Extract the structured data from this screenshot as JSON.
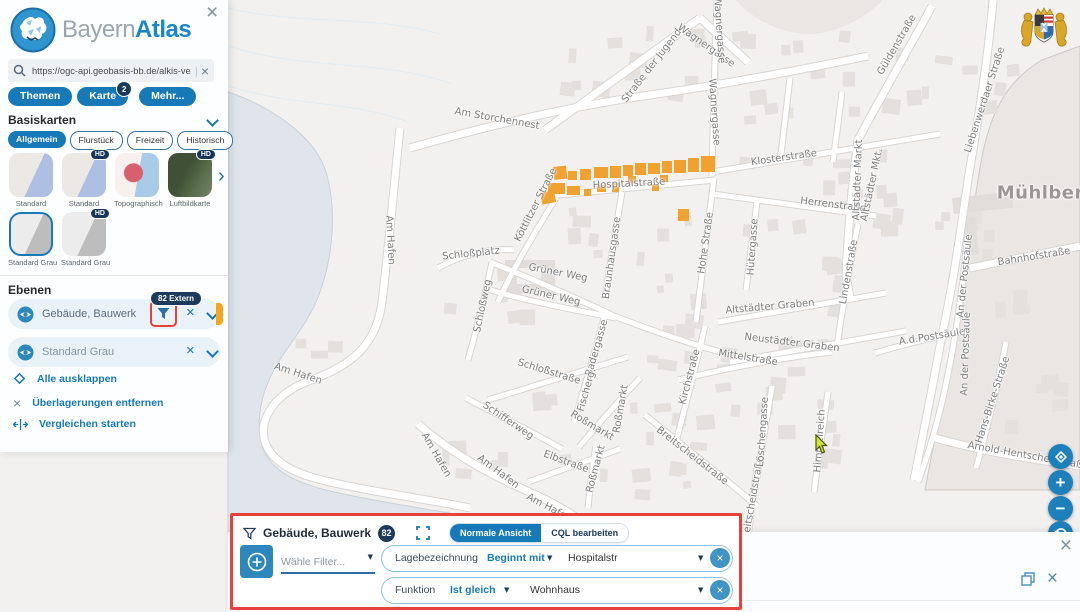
{
  "icons": {
    "close": "×",
    "caret": "▼",
    "arrow_right": "›",
    "plus": "+",
    "minus": "−"
  },
  "sidebar": {
    "logo": {
      "part1": "Bayern",
      "part2": "Atlas"
    },
    "search": {
      "value": "https://ogc-api.geobasis-bb.de/alkis-verein"
    },
    "tabs": [
      {
        "label": "Themen"
      },
      {
        "label": "Karte",
        "badge": "2"
      },
      {
        "label": "Mehr..."
      }
    ],
    "basemaps": {
      "header": "Basiskarten",
      "hd_label": "HD",
      "chips": [
        {
          "label": "Allgemein"
        },
        {
          "label": "Flurstück"
        },
        {
          "label": "Freizeit"
        },
        {
          "label": "Historisch"
        }
      ],
      "thumbs_row1": [
        {
          "label": "Standard"
        },
        {
          "label": "Standard"
        },
        {
          "label": "Topographisch"
        },
        {
          "label": "Luftbildkarte"
        }
      ],
      "thumbs_row2": [
        {
          "label": "Standard Grau"
        },
        {
          "label": "Standard Grau"
        }
      ]
    },
    "layers": {
      "header": "Ebenen",
      "items": [
        {
          "label": "Gebäude, Bauwerk",
          "badge": "82 Extern"
        },
        {
          "label": "Standard Grau"
        }
      ]
    },
    "actions": [
      {
        "label": "Alle ausklappen"
      },
      {
        "label": "Überlagerungen entfernen"
      },
      {
        "label": "Vergleichen starten"
      }
    ]
  },
  "filter_panel": {
    "title": "Gebäude, Bauwerk",
    "count": "82",
    "views": [
      {
        "label": "Normale Ansicht"
      },
      {
        "label": "CQL bearbeiten"
      }
    ],
    "add_placeholder": "Wähle Filter...",
    "rows": [
      {
        "field": "Lagebezeichnung",
        "operator": "Beginnt mit",
        "value": "Hospitalstr"
      },
      {
        "field": "Funktion",
        "operator": "Ist gleich",
        "value": "Wohnhaus"
      }
    ]
  },
  "map": {
    "colors": {
      "accent_blue": "#1779b8",
      "highlight_orange": "#f0a12f",
      "badge_navy": "#1b3a5c",
      "alert_red": "#e8403a"
    },
    "town_label": "Mühlberg",
    "street_labels": [
      {
        "t": "Straße der Jugend",
        "x": 652,
        "y": 66,
        "r": -52
      },
      {
        "t": "Wagnergasse",
        "x": 706,
        "y": 46,
        "r": 35
      },
      {
        "t": "Wagnergasse",
        "x": 719,
        "y": 30,
        "r": 86
      },
      {
        "t": "Wagnergasse",
        "x": 714,
        "y": 112,
        "r": 86
      },
      {
        "t": "Am Storchennest",
        "x": 497,
        "y": 119,
        "r": 10
      },
      {
        "t": "Klosterstraße",
        "x": 784,
        "y": 158,
        "r": -8
      },
      {
        "t": "Hospitalstraße",
        "x": 629,
        "y": 184,
        "r": -3
      },
      {
        "t": "Herrenstraße",
        "x": 833,
        "y": 205,
        "r": 7
      },
      {
        "t": "Güldenstraße",
        "x": 897,
        "y": 45,
        "r": -60
      },
      {
        "t": "Liebenwerdaer Straße",
        "x": 985,
        "y": 100,
        "r": -72
      },
      {
        "t": "Altstädter Markt",
        "x": 858,
        "y": 180,
        "r": -88
      },
      {
        "t": "Altstädter Mkt.",
        "x": 872,
        "y": 185,
        "r": -78
      },
      {
        "t": "Mühlberg",
        "x": 1047,
        "y": 193,
        "r": 0,
        "big": true
      },
      {
        "t": "Schloßplatz",
        "x": 471,
        "y": 254,
        "r": -6
      },
      {
        "t": "Schloßweg",
        "x": 483,
        "y": 306,
        "r": -78
      },
      {
        "t": "Am Hafen",
        "x": 390,
        "y": 240,
        "r": 87
      },
      {
        "t": "Am Hafen",
        "x": 298,
        "y": 374,
        "r": 18
      },
      {
        "t": "Am Hafen",
        "x": 436,
        "y": 455,
        "r": 60
      },
      {
        "t": "Am Hafen",
        "x": 498,
        "y": 472,
        "r": 37
      },
      {
        "t": "Am Hafen",
        "x": 549,
        "y": 508,
        "r": 28
      },
      {
        "t": "Schifferweg",
        "x": 508,
        "y": 421,
        "r": 34
      },
      {
        "t": "Elbstraße",
        "x": 566,
        "y": 462,
        "r": 20
      },
      {
        "t": "Roßmarkt",
        "x": 592,
        "y": 426,
        "r": 31
      },
      {
        "t": "Roßmarkt",
        "x": 596,
        "y": 469,
        "r": -75
      },
      {
        "t": "Roßmarkt",
        "x": 621,
        "y": 409,
        "r": -80
      },
      {
        "t": "Badergasse",
        "x": 597,
        "y": 348,
        "r": -74
      },
      {
        "t": "Fischerg.",
        "x": 587,
        "y": 390,
        "r": -74
      },
      {
        "t": "Breitscheidstraße",
        "x": 692,
        "y": 456,
        "r": 38
      },
      {
        "t": "Breitscheidstraße",
        "x": 753,
        "y": 500,
        "r": -80
      },
      {
        "t": "Kirchstraße",
        "x": 690,
        "y": 377,
        "r": -75
      },
      {
        "t": "Hohe Straße",
        "x": 706,
        "y": 243,
        "r": -82
      },
      {
        "t": "Hütergasse",
        "x": 753,
        "y": 247,
        "r": -86
      },
      {
        "t": "Braunhausgasse",
        "x": 612,
        "y": 258,
        "r": -82
      },
      {
        "t": "Grüner Weg",
        "x": 558,
        "y": 273,
        "r": 11
      },
      {
        "t": "Grüner Weg",
        "x": 551,
        "y": 296,
        "r": 13
      },
      {
        "t": "Altstädter Graben",
        "x": 770,
        "y": 307,
        "r": -5
      },
      {
        "t": "Neustädter Graben",
        "x": 792,
        "y": 343,
        "r": 7
      },
      {
        "t": "Mittelstraße",
        "x": 748,
        "y": 358,
        "r": 9
      },
      {
        "t": "Löschengasse",
        "x": 763,
        "y": 432,
        "r": -86
      },
      {
        "t": "Himmelreich",
        "x": 820,
        "y": 441,
        "r": -86
      },
      {
        "t": "Lindenstraße",
        "x": 849,
        "y": 272,
        "r": -80
      },
      {
        "t": "Bahnhofstraße",
        "x": 1034,
        "y": 257,
        "r": -9
      },
      {
        "t": "A.d.Postsäule",
        "x": 932,
        "y": 337,
        "r": -9
      },
      {
        "t": "An der Postsäule",
        "x": 965,
        "y": 276,
        "r": -84
      },
      {
        "t": "An der Postsäule",
        "x": 966,
        "y": 354,
        "r": -88
      },
      {
        "t": "Hans-Birke-Straße",
        "x": 993,
        "y": 400,
        "r": -72
      },
      {
        "t": "Arnold-Hentschel-Straße",
        "x": 1028,
        "y": 456,
        "r": 10
      },
      {
        "t": "Köttlitzer Straße",
        "x": 536,
        "y": 205,
        "r": -63
      },
      {
        "t": "Schloßstraße",
        "x": 549,
        "y": 372,
        "r": 17
      }
    ]
  }
}
